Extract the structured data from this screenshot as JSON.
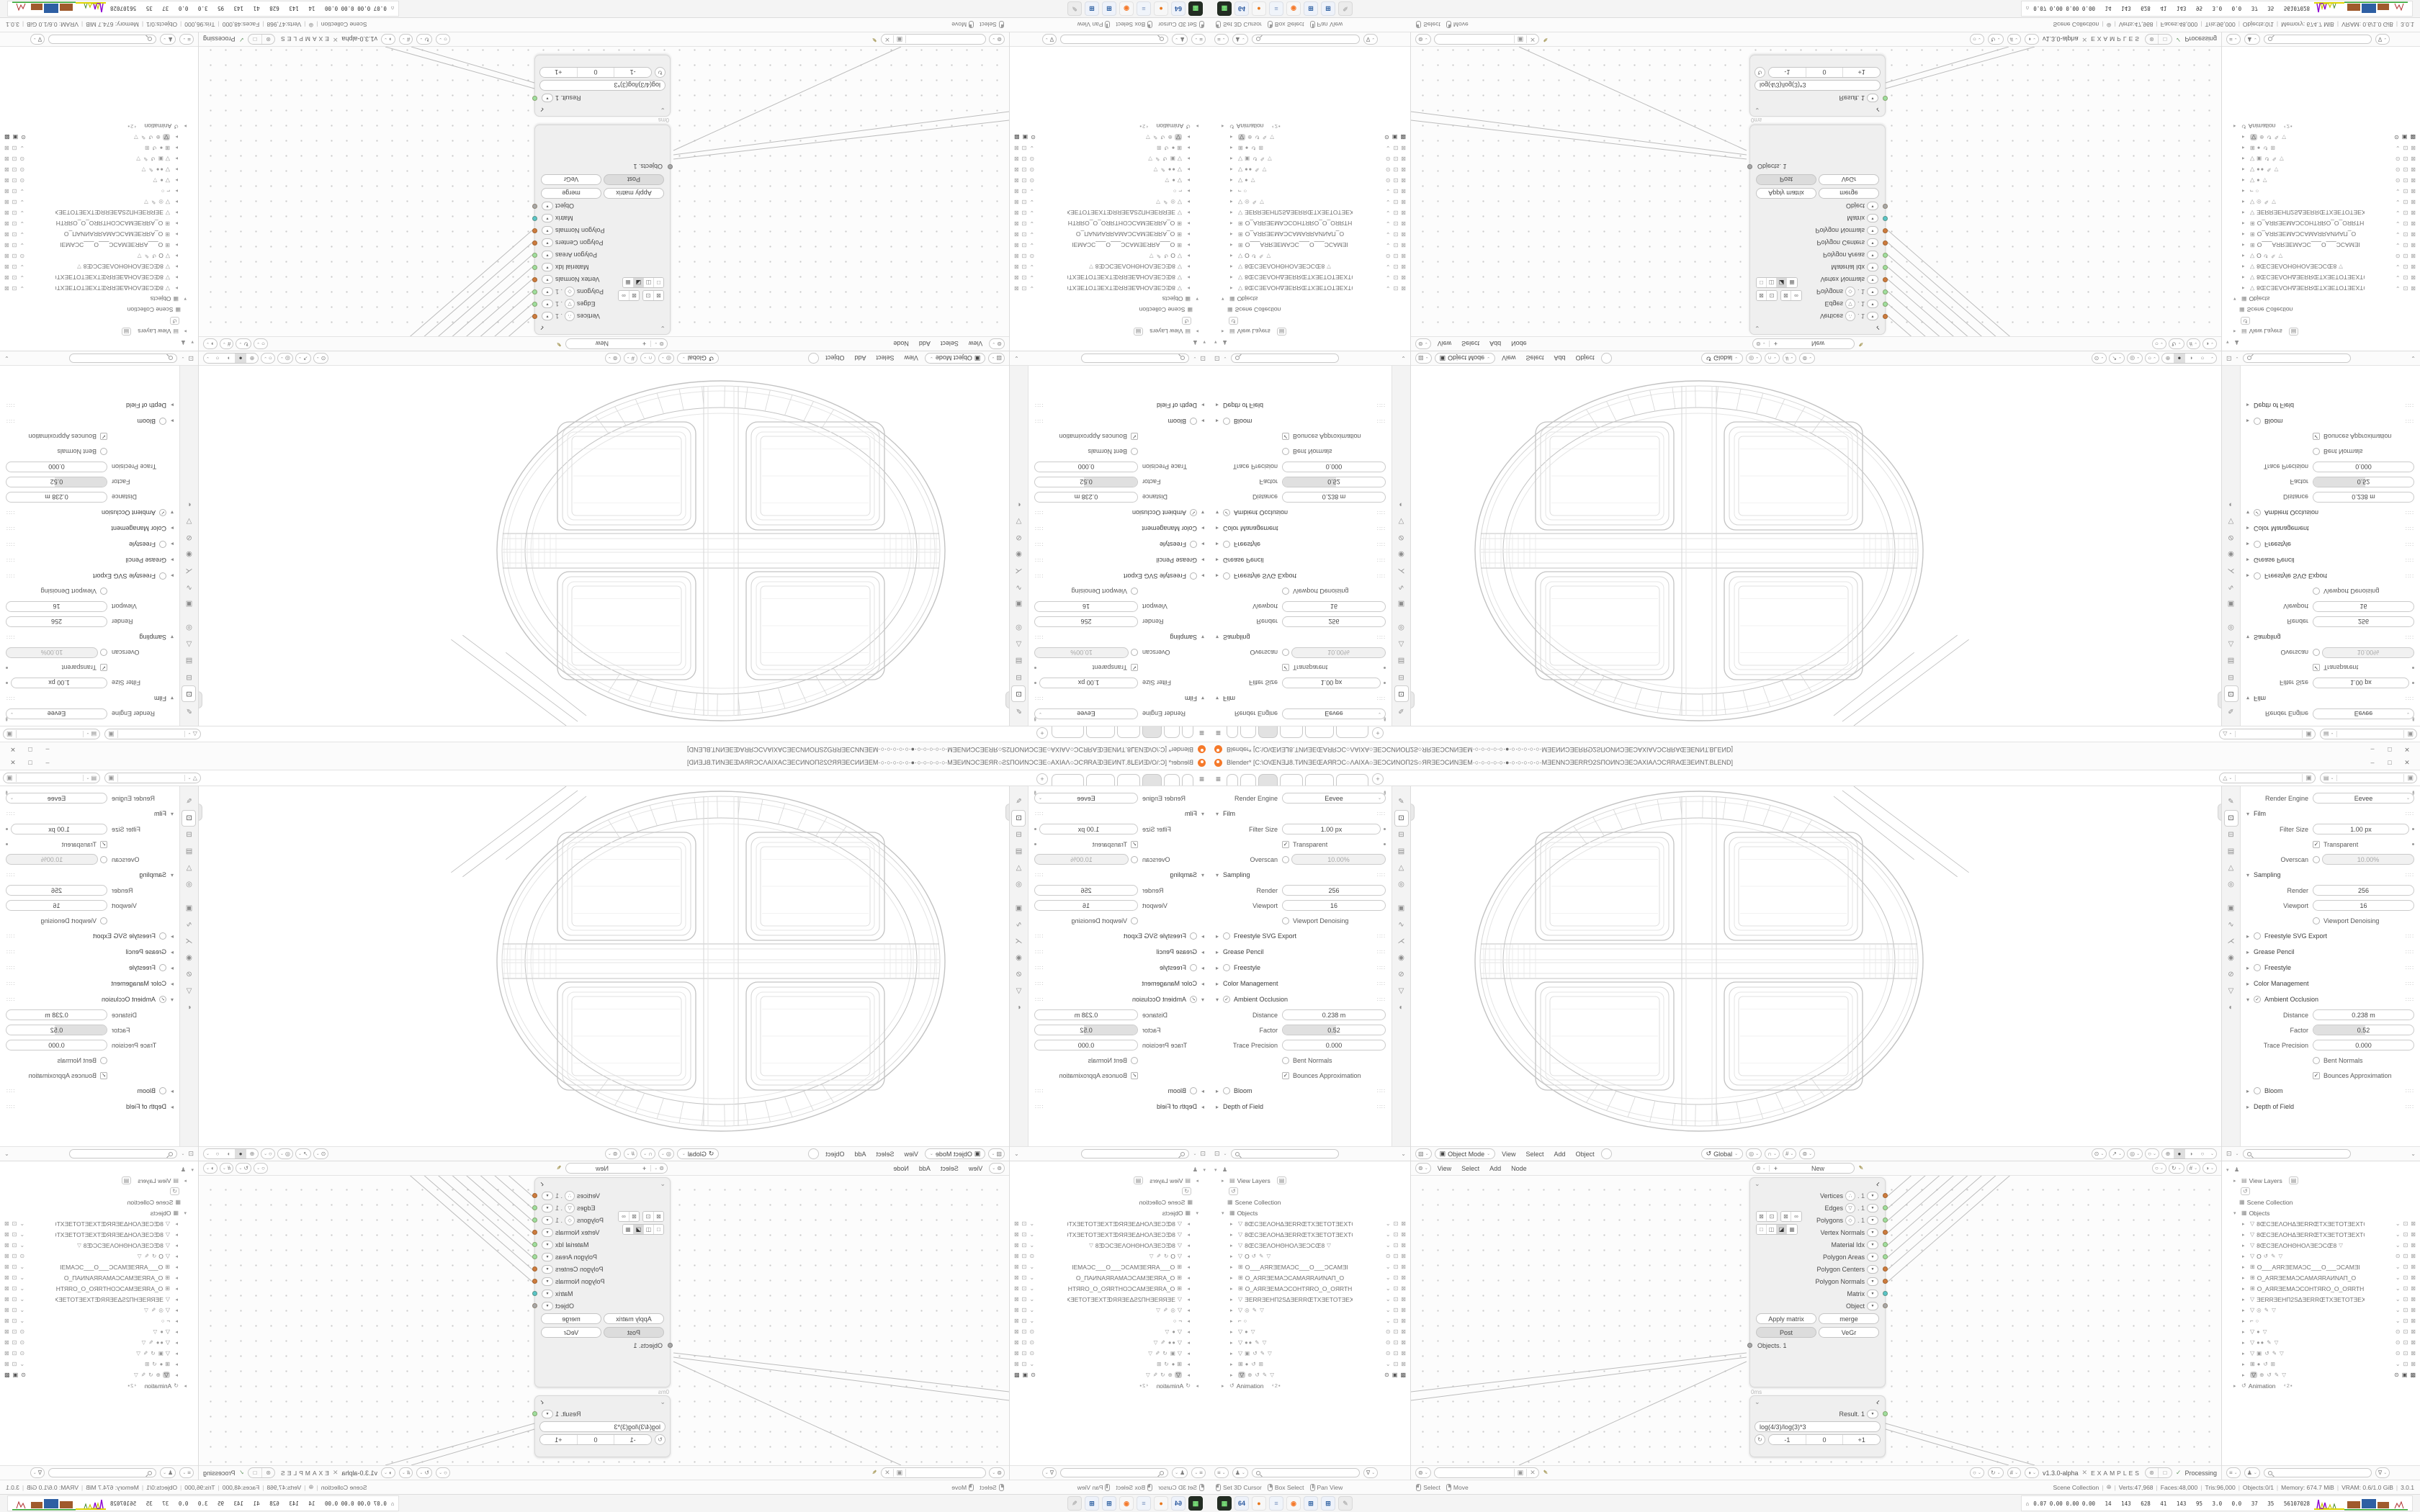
{
  "window": {
    "title": "Blender* [C:\\O\\ŒNƎ⅃8.TИNƎEŒAЯRƆC○ΛAIXA○ƎEƆCИNOΠ2S○ЯRƎEƆCИNƎEM·○·○·○·○·○·●·○·○·○·○·○·MƎENNƆƎERR⅁2SΠOИNƆƎEƆAXIAΛƆCЯRAŒƎEИNT.BLEND]",
    "controls": [
      "–",
      "□",
      "✕"
    ]
  },
  "topbar": {
    "menu_icon": "≡",
    "tab_count": 6,
    "active_tab": 2,
    "new_tab_label": "+",
    "scene_field": {
      "icon": "△",
      "value": "",
      "copy_icon": "▣"
    },
    "layer_field": {
      "icon": "▤",
      "value": "",
      "copy_icon": "▣"
    }
  },
  "properties": {
    "pin_icon": "✒",
    "engine_label": "Render Engine",
    "engine_value": "Eevee",
    "tabs": [
      {
        "name": "tool",
        "glyph": "✎"
      },
      {
        "name": "render",
        "glyph": "⊡",
        "active": true
      },
      {
        "name": "output",
        "glyph": "⊟"
      },
      {
        "name": "view-layer",
        "glyph": "▤"
      },
      {
        "name": "scene",
        "glyph": "△"
      },
      {
        "name": "world",
        "glyph": "◎"
      },
      {
        "name": "object",
        "glyph": "▣"
      },
      {
        "name": "modifiers",
        "glyph": "∿"
      },
      {
        "name": "particles",
        "glyph": "⋌"
      },
      {
        "name": "physics",
        "glyph": "◉"
      },
      {
        "name": "constraints",
        "glyph": "⊘"
      },
      {
        "name": "object-data",
        "glyph": "▽"
      },
      {
        "name": "material",
        "glyph": "◐"
      }
    ],
    "sections": [
      {
        "title": "Film",
        "state": "open",
        "rows": [
          {
            "kind": "field",
            "label": "Filter Size",
            "value": "1.00 px",
            "dot": true
          },
          {
            "kind": "check",
            "label": "Transparent",
            "checked": true,
            "dot": true
          },
          {
            "kind": "toggle_field",
            "label": "Overscan",
            "value": "10.00%",
            "checked": false
          }
        ]
      },
      {
        "title": "Sampling",
        "state": "open",
        "rows": [
          {
            "kind": "field",
            "label": "Render",
            "value": "256"
          },
          {
            "kind": "field",
            "label": "Viewport",
            "value": "16"
          },
          {
            "kind": "check",
            "label": "Viewport Denoising",
            "checked": false
          }
        ]
      },
      {
        "title": "Freestyle SVG Export",
        "state": "closed",
        "check": "empty"
      },
      {
        "title": "Grease Pencil",
        "state": "closed"
      },
      {
        "title": "Freestyle",
        "state": "closed",
        "check": "empty"
      },
      {
        "title": "Color Management",
        "state": "closed"
      },
      {
        "title": "Ambient Occlusion",
        "state": "open",
        "check": "checked",
        "rows": [
          {
            "kind": "field",
            "label": "Distance",
            "value": "0.238 m"
          },
          {
            "kind": "slider",
            "label": "Factor",
            "value": "0.52",
            "fill": 52
          },
          {
            "kind": "field",
            "label": "Trace Precision",
            "value": "0.000"
          },
          {
            "kind": "check",
            "label": "Bent Normals",
            "checked": false
          },
          {
            "kind": "check",
            "label": "Bounces Approximation",
            "checked": true
          }
        ]
      },
      {
        "title": "Bloom",
        "state": "closed",
        "check": "empty"
      },
      {
        "title": "Depth of Field",
        "state": "closed"
      }
    ],
    "footer_icon": "⊡",
    "dots_glyph": "∷∷"
  },
  "viewport": {
    "editor_icon": "▧",
    "mode_icon": "▣",
    "mode_label": "Object Mode",
    "menus": [
      "View",
      "Select",
      "Add",
      "Object"
    ],
    "orientation_icon": "↺",
    "orientation_label": "Global",
    "snap_icons": [
      {
        "name": "globe",
        "glyph": "◎"
      },
      {
        "name": "magnet-snap",
        "glyph": "∩"
      },
      {
        "name": "grid-snap",
        "glyph": "#"
      },
      {
        "name": "proportional-edit",
        "glyph": "⊚"
      }
    ],
    "right_icons": [
      {
        "name": "camera-view",
        "glyph": "⊙"
      },
      {
        "name": "gizmo",
        "glyph": "↗"
      },
      {
        "name": "overlays",
        "glyph": "◎"
      },
      {
        "name": "xray-toggle",
        "glyph": "○"
      }
    ],
    "shading_modes": [
      {
        "name": "wireframe-shading",
        "glyph": "⊕"
      },
      {
        "name": "solid-shading",
        "glyph": "●",
        "active": true
      },
      {
        "name": "material-shading",
        "glyph": "◑"
      },
      {
        "name": "rendered-shading",
        "glyph": "○"
      }
    ]
  },
  "outliner": {
    "display_icon": "♟",
    "view_layers_label": "View Layers",
    "history_icon": "↺",
    "scene_collection_label": "Scene Collection",
    "objects_label": "Objects",
    "animation_label": "Animation",
    "animation_suffix": "⁴2▪",
    "rows": [
      {
        "icon": "▽",
        "name": "8ŒCƎEΛOHΔƎERRŒTXƎETOTƎEXTŒ8",
        "extras": "",
        "vis": "chev"
      },
      {
        "icon": "▽",
        "name": "8ŒCƎEΛOHΔƎERRŒTXƎETOTƎEXTŒ8",
        "extras": "",
        "vis": "chev"
      },
      {
        "icon": "▽",
        "name": "8ŒCƎEΛOHΘHOΛƎEƆCŒ8",
        "extras": "▽",
        "vis": "chev"
      },
      {
        "icon": "▽",
        "name": "O",
        "extras": "↺ ✎ ▽",
        "vis": "eye"
      },
      {
        "icon": "⊞",
        "name": "O___AЯRƎEMAƆC___O___ƆCAMƎI",
        "extras": "",
        "vis": "chev"
      },
      {
        "icon": "⊞",
        "name": "O_AЯRƎEMAƆCAMAЯRAИNAΠ_O",
        "extras": "",
        "vis": "chev"
      },
      {
        "icon": "⊞",
        "name": "O_AЯRƎEMAƆCOHTЯRO_O_OЯRTH",
        "extras": "",
        "vis": "chev"
      },
      {
        "icon": "▽",
        "name": "ƎERRƎEHΠ2SΔƎERRŒTXƎETOTƎEXTŒ",
        "extras": "",
        "vis": "chev"
      },
      {
        "icon": "▽",
        "name": "",
        "extras": "◎ ✎ ▽",
        "vis": "chev"
      },
      {
        "icon": "⌐",
        "name": "",
        "extras": "○",
        "vis": "chev"
      },
      {
        "icon": "▽",
        "name": "",
        "extras": "● ▽",
        "vis": "eye"
      },
      {
        "icon": "▽",
        "name": "",
        "extras": "●● ✎ ▽",
        "vis": "eye"
      },
      {
        "icon": "▽",
        "name": "",
        "extras": "▣ ↺ ✎ ▽",
        "vis": "eye"
      },
      {
        "icon": "⊞",
        "name": "",
        "extras": "● ↺ ⊞",
        "vis": "chev"
      },
      {
        "icon": "▽",
        "name": "",
        "extras": "⊕ ↺ ✎ ▽",
        "vis": "eye",
        "highlighted": true
      }
    ],
    "row_toggles": {
      "chev": [
        "⌄",
        "⊡",
        "⊠"
      ],
      "eye": [
        "⊙",
        "⊡",
        "⊠"
      ],
      "hl": [
        "⊙",
        "▣",
        "▩"
      ]
    },
    "footer_icons": [
      "≡",
      "♟"
    ],
    "filter_icon": "∇"
  },
  "node_editor": {
    "editor_icon": "⊚",
    "menus": [
      "View",
      "Select",
      "Add",
      "Node"
    ],
    "tree_selector": {
      "icon": "⊚",
      "plus": "+",
      "label": "New"
    },
    "pin_icon": "✒",
    "header_right_icons": [
      "○",
      "↻",
      "#",
      "◑"
    ],
    "upper_node": {
      "collapse_icon": "⌄",
      "badge_icon": "⌐",
      "display_buttons_row1": [
        [
          "⊠",
          "⊡"
        ],
        [
          "⊠",
          "∞"
        ]
      ],
      "display_buttons_row2": [
        "□",
        "◫",
        "◪",
        "▦"
      ],
      "row2_active": 2,
      "outputs": [
        {
          "label": "Vertices",
          "icon": "∴",
          "suffix": ". 1",
          "color": "orange"
        },
        {
          "label": "Edges",
          "icon": "▽",
          "suffix": ". 1",
          "color": "green"
        },
        {
          "label": "Polygons",
          "icon": "◇",
          "suffix": ". 1",
          "color": "green"
        },
        {
          "label": "Vertex Normals",
          "icon": "",
          "suffix": "",
          "color": "orange"
        },
        {
          "label": "Material Idx",
          "icon": "",
          "suffix": "",
          "color": "green"
        },
        {
          "label": "Polygon Areas",
          "icon": "",
          "suffix": "",
          "color": "green"
        },
        {
          "label": "Polygon Centers",
          "icon": "",
          "suffix": "",
          "color": "orange"
        },
        {
          "label": "Polygon Normals",
          "icon": "",
          "suffix": "",
          "color": "orange"
        },
        {
          "label": "Matrix",
          "icon": "",
          "suffix": "",
          "color": "teal"
        },
        {
          "label": "Object",
          "icon": "",
          "suffix": "",
          "color": "gray"
        }
      ],
      "buttons": [
        [
          "Apply matrix",
          "merge"
        ],
        [
          "Post",
          "VeGr"
        ]
      ],
      "pressed_button": "Post",
      "object_output": {
        "label": "Objects. 1",
        "color": "gray"
      },
      "time_label": "0ms"
    },
    "lower_node": {
      "collapse_icon": "⌄",
      "badge_icon": "⌐",
      "result": {
        "label": "Result. 1",
        "color": "green"
      },
      "formula": "log(4/3)/log(3)*3",
      "loop_icon": "↻",
      "stepper": [
        "-1",
        "0",
        "+1"
      ]
    },
    "footer": {
      "tree_icon": "⊚",
      "field_value": "",
      "mini_icons": [
        "▣",
        "✕"
      ],
      "pin": "✒",
      "right_icons": [
        "○",
        "↻",
        "#",
        "◑"
      ],
      "version": "v1.3.0-alpha",
      "close": "✕",
      "examples": "EXAMPLES",
      "pair_icons": [
        "⊛",
        "□"
      ],
      "check": "✓",
      "processing": "Processing"
    }
  },
  "status_bar": {
    "hints": [
      {
        "btn": "left",
        "label": "Set 3D Cursor"
      },
      {
        "btn": "right",
        "label": "Box Select"
      },
      {
        "btn": "mid",
        "label": "Pan View"
      }
    ],
    "hints2": [
      {
        "btn": "left",
        "label": "Select"
      },
      {
        "btn": "right",
        "label": "Move"
      }
    ],
    "collection_label": "Scene Collection",
    "globe_icon": "⊕",
    "stats": [
      "Verts:47,968",
      "Faces:48,000",
      "Tris:96,000",
      "Objects:0/1",
      "Memory: 674.7 MiB",
      "VRAM: 0.6/1.0 GiB",
      "3.0.1"
    ]
  },
  "taskbar": {
    "apps": [
      {
        "name": "terminal",
        "bg": "#232d23",
        "fg": "#7be37b",
        "glyph": "▦"
      },
      {
        "name": "save-64",
        "bg": "#eef2fa",
        "fg": "#2c5aa0",
        "glyph": "64"
      },
      {
        "name": "firefox",
        "bg": "#f7f7f7",
        "fg": "#e8761a",
        "glyph": "●"
      },
      {
        "name": "notepad",
        "bg": "#f0f4fa",
        "fg": "#7a94c0",
        "glyph": "≡"
      },
      {
        "name": "blender",
        "bg": "#f7f7f7",
        "fg": "#f5792a",
        "glyph": "◉"
      },
      {
        "name": "calculator",
        "bg": "#eef2fa",
        "fg": "#3465a4",
        "glyph": "⊞"
      },
      {
        "name": "calculator-2",
        "bg": "#eef2fa",
        "fg": "#3465a4",
        "glyph": "⊞"
      },
      {
        "name": "stylus",
        "bg": "#ececec",
        "fg": "#b8b8b8",
        "glyph": "✎"
      }
    ],
    "monitor": {
      "icon": "⌂",
      "values": "0.07 0.00 0.00 0.00   14   143   628   41   143   95   3.0   0.0   37   35   56107028"
    }
  },
  "colors": {
    "socket_orange": "#cd7b3e",
    "socket_green": "#9fdf9f",
    "socket_teal": "#59c5c8",
    "socket_gray": "#a8a8a8",
    "wire": "#bcbcbc",
    "wireframe_dark": "#c3c3c3",
    "wireframe_mid": "#d6d6d6",
    "wireframe_light": "#e5e5e5",
    "accent_orange": "#f5792a"
  }
}
